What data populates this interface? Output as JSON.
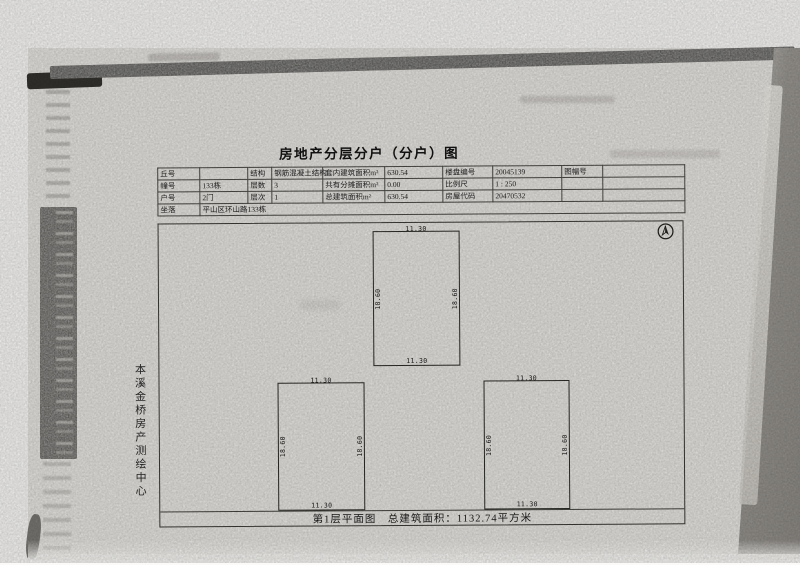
{
  "title": "房地产分层分户（分户）图",
  "info_table": {
    "rows": [
      [
        "丘号",
        "",
        "结构",
        "钢筋混凝土结构",
        "套内建筑面积m²",
        "630.54",
        "楼盘编号",
        "20045139",
        "图幅号",
        ""
      ],
      [
        "幢号",
        "133栋",
        "层数",
        "3",
        "共有分摊面积m²",
        "0.00",
        "比例尺",
        "1 : 250",
        "",
        ""
      ],
      [
        "户号",
        "2门",
        "层次",
        "1",
        "总建筑面积m²",
        "630.54",
        "房屋代码",
        "20470532",
        "",
        ""
      ]
    ],
    "address_label": "坐落",
    "address_value": "平山区环山路133栋"
  },
  "plan": {
    "caption": "第1层平面图　总建筑面积：1132.74平方米",
    "compass_icon": "north-arrow",
    "units": [
      {
        "width_top": "11.30",
        "width_bottom": "11.30",
        "depth_left": "18.60",
        "depth_right": "18.60"
      },
      {
        "width_top": "11.30",
        "width_bottom": "11.30",
        "depth_left": "18.60",
        "depth_right": "18.60"
      },
      {
        "width_top": "11.30",
        "width_bottom": "11.30",
        "depth_left": "18.60",
        "depth_right": "18.60"
      }
    ]
  },
  "side_label": "本溪金桥房产测绘中心",
  "colors": {
    "paper": "#e9e7e3",
    "ink": "#1d1d1d",
    "scan_band": "#4b4a47"
  }
}
